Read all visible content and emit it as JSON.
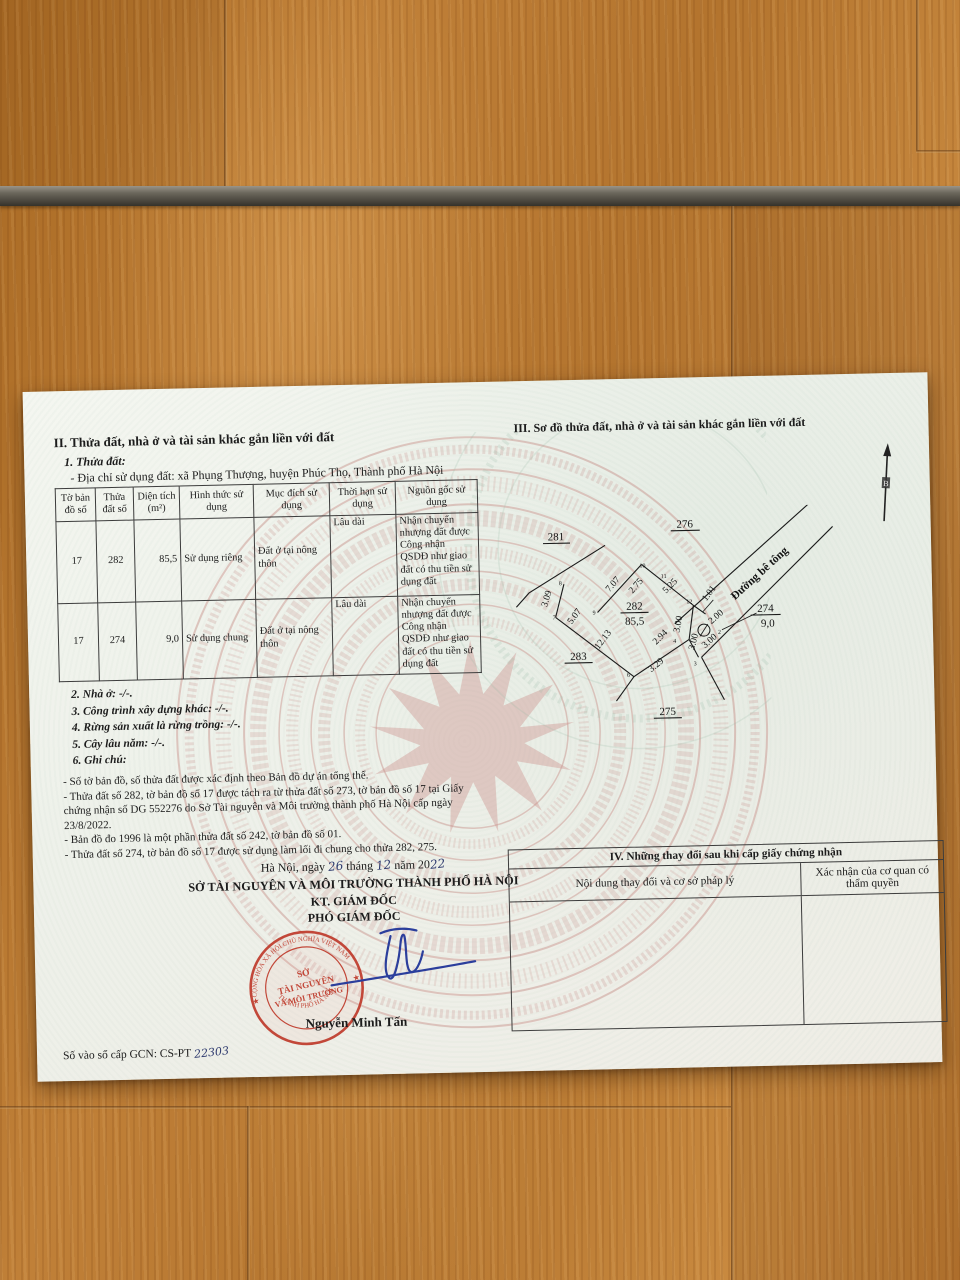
{
  "section2": {
    "title": "II. Thửa đất, nhà ở và tài sản khác gắn liền với đất",
    "sub1_title": "1. Thửa đất:",
    "address_line": "- Địa chỉ sử dụng đất:  xã Phụng Thượng, huyện Phúc Thọ, Thành phố Hà Nội",
    "table": {
      "headers": [
        "Tờ bản đồ số",
        "Thửa đất số",
        "Diện tích (m²)",
        "Hình thức sử dụng",
        "Mục đích sử dụng",
        "Thời hạn sử dụng",
        "Nguồn gốc sử dụng"
      ],
      "rows": [
        {
          "sheet": "17",
          "parcel": "282",
          "area": "85,5",
          "form": "Sử dụng riêng",
          "purpose": "Đất ở tại nông thôn",
          "term": "Lâu dài",
          "origin": "Nhận chuyển nhượng đất được Công nhận QSDĐ như giao đất có thu tiền sử dụng đất"
        },
        {
          "sheet": "17",
          "parcel": "274",
          "area": "9,0",
          "form": "Sử dụng chung",
          "purpose": "Đất ở tại nông thôn",
          "term": "Lâu dài",
          "origin": "Nhận chuyển nhượng đất được Công nhận QSDĐ như giao đất có thu tiền sử dụng đất"
        }
      ]
    },
    "items": [
      "2. Nhà ở:  -/-.",
      "3. Công trình xây dựng khác: -/-.",
      "4. Rừng sản xuất là rừng trồng: -/-.",
      "5. Cây lâu năm:  -/-.",
      "6. Ghi chú:"
    ],
    "notes": [
      "- Số tờ bản đồ, số thửa đất được xác định theo Bản đồ dự án tổng thể.",
      "- Thửa đất số 282, tờ bản đồ số 17 được tách ra từ thửa đất số 273, tờ bản đồ số 17 tại Giấy chứng nhận số DG 552276 do Sở Tài nguyên và Môi trường thành phố Hà Nội cấp ngày 23/8/2022.",
      "- Bản đồ đo 1996 là một phần thửa đất số 242, tờ bản đồ số 01.",
      "- Thửa đất số 274, tờ bản đồ số 17 được sử dụng làm lối đi chung cho thửa 282, 275."
    ]
  },
  "signing": {
    "place_prefix": "Hà Nội, ngày",
    "day": "26",
    "month_label": "tháng",
    "month": "12",
    "year_label": "năm 20",
    "year": "22",
    "org": "SỞ TÀI NGUYÊN VÀ MÔI TRƯỜNG THÀNH PHỐ HÀ NỘI",
    "kt": "KT. GIÁM ĐỐC",
    "deputy": "PHÓ GIÁM ĐỐC",
    "signer": "Nguyễn Minh Tấn",
    "seal": {
      "arc_top": "CỘNG HÒA XÃ HỘI CHỦ NGHĨA VIỆT NAM",
      "arc_bottom": "THÀNH PHỐ HÀ NỘI",
      "line1": "SỞ",
      "line2": "TÀI NGUYÊN",
      "line3": "VÀ MÔI TRƯỜNG",
      "star": "★",
      "color": "#bf3a2b"
    },
    "ink_color": "#2b3e9c"
  },
  "registry": {
    "label": "Số vào sổ cấp GCN: CS-PT",
    "number": "22303"
  },
  "section3": {
    "title": "III. Sơ đồ thửa đất, nhà ở và tài sản khác gắn liền với đất",
    "north_label": "B",
    "diagram": {
      "road_name": "Đường bê tông",
      "parcels": [
        {
          "t": "281"
        },
        {
          "t": "276"
        },
        {
          "t": "282"
        },
        {
          "t": "85,5"
        },
        {
          "t": "283"
        },
        {
          "t": "275"
        },
        {
          "t": "274"
        },
        {
          "t": "9,0"
        }
      ],
      "measures": [
        {
          "t": "7.07"
        },
        {
          "t": "2.75"
        },
        {
          "t": "5.25"
        },
        {
          "t": "1.01"
        },
        {
          "t": "3.09"
        },
        {
          "t": "5.07"
        },
        {
          "t": "12.13"
        },
        {
          "t": "2.94"
        },
        {
          "t": "3.29"
        },
        {
          "t": "3.00"
        },
        {
          "t": "3.00"
        },
        {
          "t": "3.00"
        },
        {
          "t": "2.00"
        }
      ],
      "ticks": [
        "10",
        "11",
        "12",
        "9",
        "8",
        "7",
        "6",
        "4",
        "3",
        "2"
      ]
    }
  },
  "section4": {
    "title": "IV. Những thay đổi sau khi cấp giấy chứng nhận",
    "col1": "Nội dung thay đổi và cơ sở pháp lý",
    "col2": "Xác nhận của cơ quan có thẩm quyền"
  }
}
